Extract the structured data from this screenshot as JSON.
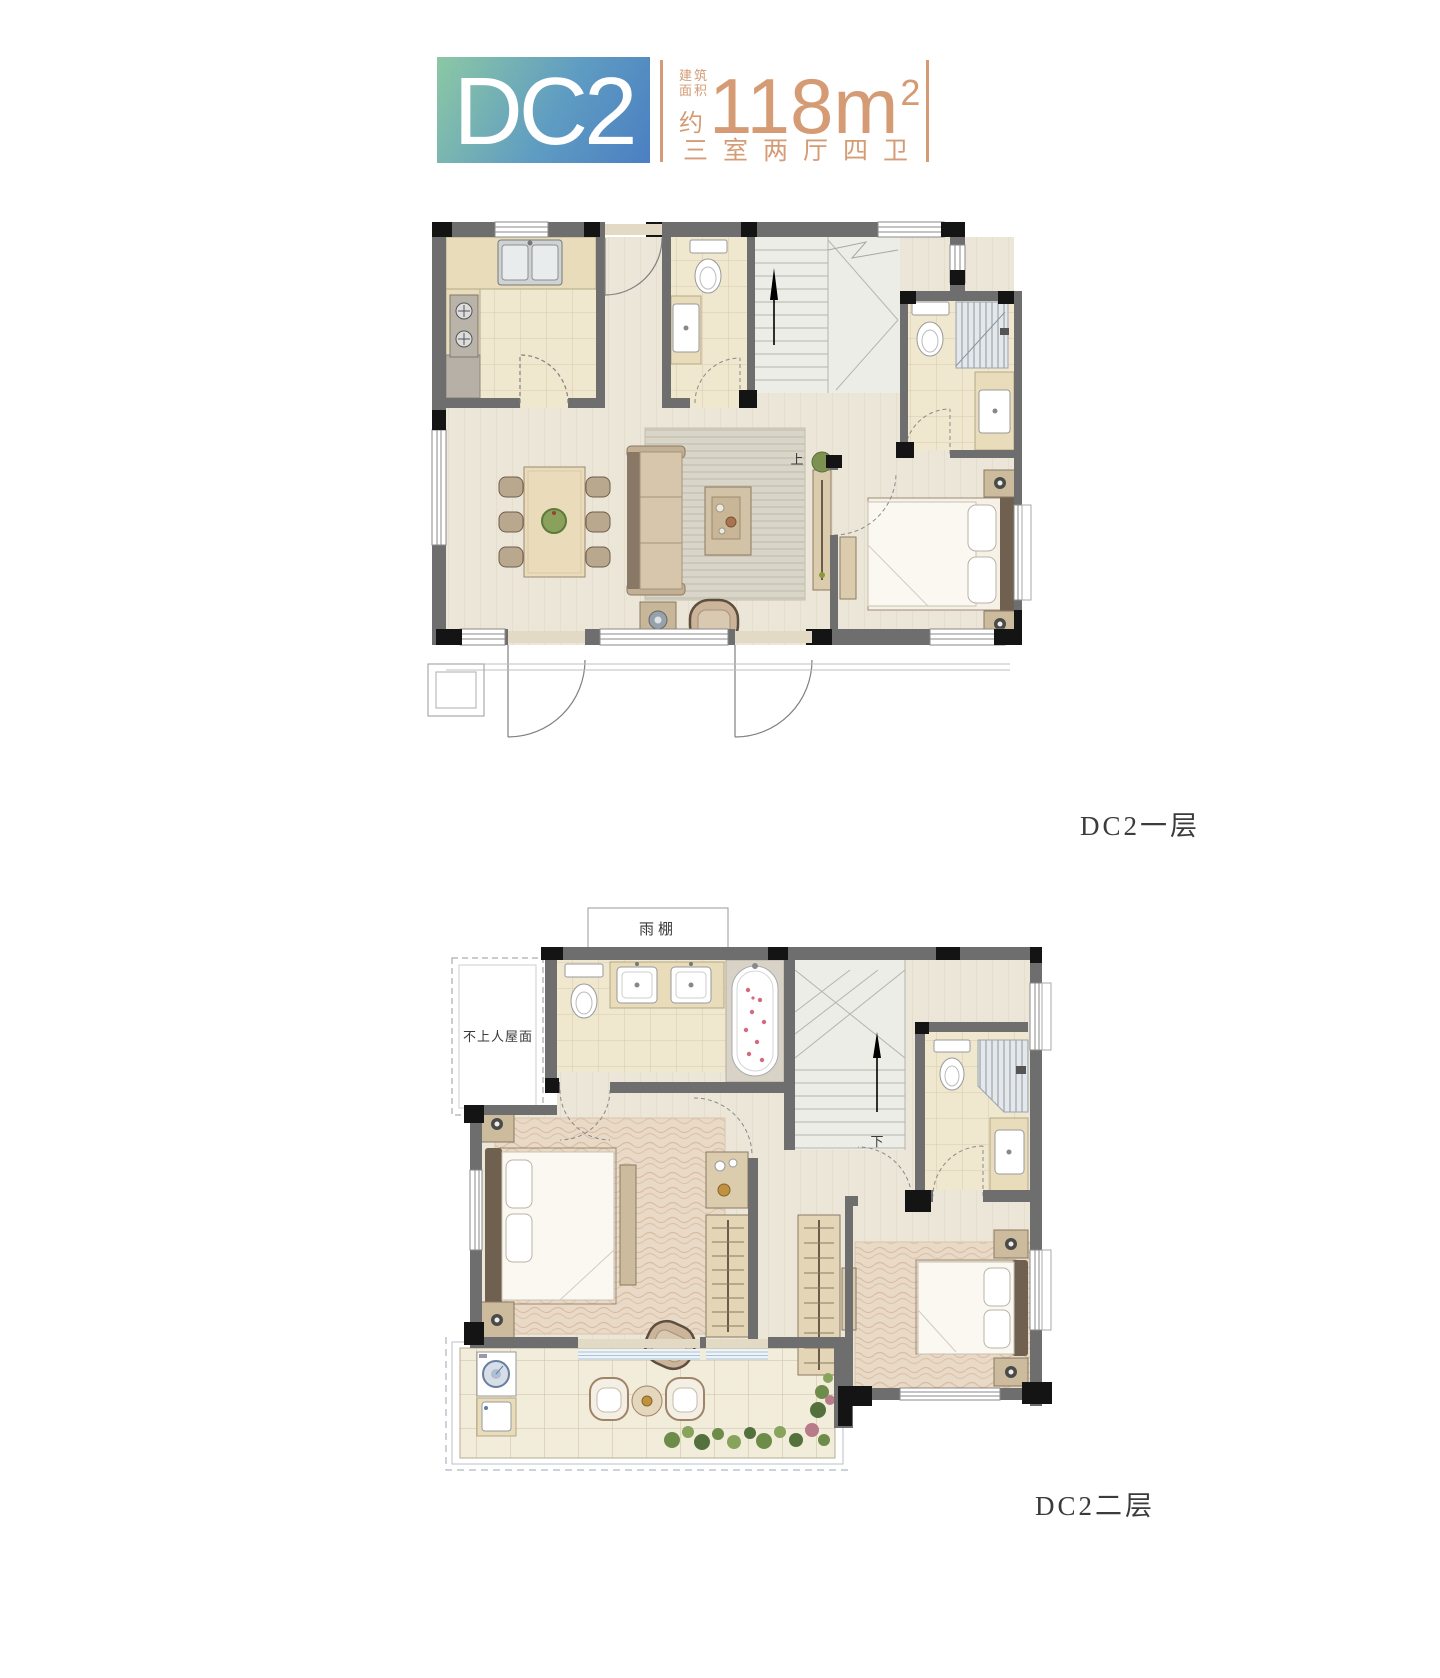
{
  "header": {
    "unit_name": "DC2",
    "area_label_line1": "建筑",
    "area_label_line2": "面积",
    "area_prefix": "约",
    "area_value": "118m",
    "area_exponent": "2",
    "layout_desc": "三室两厅四卫",
    "accent_color": "#D49B74",
    "logo_gradient_from": "#8CC8A4",
    "logo_gradient_to": "#4B7FC2"
  },
  "floor1": {
    "label": "DC2一层",
    "stair_direction": "上"
  },
  "floor2": {
    "label": "DC2二层",
    "stair_direction": "下",
    "canopy_label": "雨棚",
    "roof_label": "不上人屋面"
  }
}
